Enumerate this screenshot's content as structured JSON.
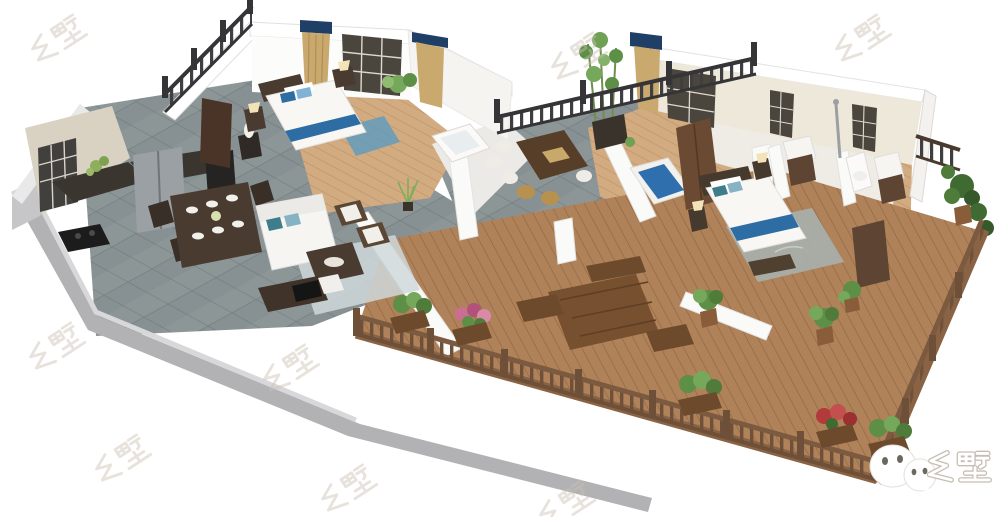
{
  "image": {
    "description": "3D isometric cutaway floor-plan rendering of a country villa: kitchen, dining room, living room, three bedrooms, bathrooms, a tea terrace and a large wood deck with planters and railings",
    "background_color": "#ffffff"
  },
  "watermark": {
    "text": "乡墅",
    "color": "#c9c0b2",
    "style": "faint, rotated, repeated over white background",
    "count": 8
  },
  "brand": {
    "icon": "wechat-icon",
    "text": "乡墅",
    "text_color": "#ffffff",
    "outline_color": "#c5beb2"
  },
  "palette": {
    "slate_tile": "#8D9697",
    "deck_wood": "#B08259",
    "room_wood": "#D2AB80",
    "wall_white": "#FFFFFF",
    "plinth_gray": "#B2B2B4",
    "marble_wall": "#D9D1C2",
    "bath_tile": "#EFE9DD",
    "metal_railing": "#3F3F42",
    "wood_railing": "#6F513B",
    "bed_blue": "#2E6DA4",
    "pillow_teal": "#3E7D8A",
    "curtain_tan": "#C9A96E",
    "valance_navy": "#1F3F66",
    "plant_green": "#5D8F46",
    "flower_pink": "#CB6F90",
    "flower_red": "#B23A3A",
    "furniture_dark": "#4A3B30"
  },
  "scene": {
    "areas": [
      {
        "name": "kitchen",
        "items": [
          "marble walls",
          "lattice window",
          "dark counters",
          "cooktop",
          "two fridges"
        ]
      },
      {
        "name": "dining-room",
        "items": [
          "dark wood table",
          "six place settings",
          "chairs",
          "flower centerpiece"
        ]
      },
      {
        "name": "living-room",
        "items": [
          "white sofa with teal pillows",
          "coffee table",
          "two wood armchairs",
          "tv console",
          "light blue rug"
        ]
      },
      {
        "name": "bedroom-1",
        "items": [
          "white bed with blue runner",
          "blue pillows",
          "nightstands with lamps",
          "tan curtains",
          "navy valances",
          "lattice window",
          "blue rug"
        ]
      },
      {
        "name": "bathroom-1",
        "items": [
          "bathtub",
          "white tile walls"
        ]
      },
      {
        "name": "tea-terrace",
        "items": [
          "dark tea table",
          "white drum stools",
          "rattan drum stools",
          "black metal railing",
          "potted bamboo"
        ]
      },
      {
        "name": "bedroom-2",
        "items": [
          "blue platform bed",
          "brown wardrobe"
        ]
      },
      {
        "name": "master-bedroom",
        "items": [
          "white bed with blue runner",
          "gray patterned rug",
          "nightstands with lamps",
          "dark dresser"
        ]
      },
      {
        "name": "bathrooms-rear",
        "items": [
          "toilet",
          "two vanity sinks",
          "shower",
          "beige tile walls",
          "lattice windows"
        ]
      },
      {
        "name": "wood-deck",
        "items": [
          "plank flooring",
          "outdoor table with benches",
          "wood railing",
          "planter boxes with pink and red flowers",
          "potted shrubs"
        ]
      }
    ]
  }
}
